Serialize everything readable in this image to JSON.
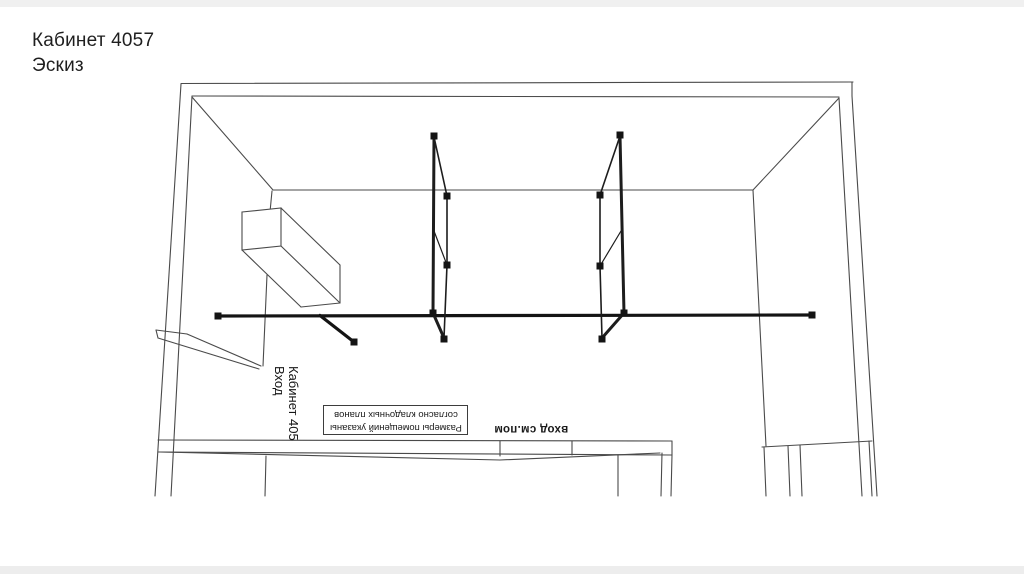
{
  "slide": {
    "title": "Кабинет 4057",
    "subtitle": "Эскиз"
  },
  "annotations": {
    "entry_label_line1": "Кабинет 405",
    "entry_label_line2": "Вход",
    "note_line1": "Размеры помещений указаны",
    "note_line2": "согласно кладочных планов",
    "entrance_note": "вход см.пом"
  },
  "colors": {
    "line": "#4a4a4a",
    "accent": "#141414",
    "background": "#ffffff"
  }
}
